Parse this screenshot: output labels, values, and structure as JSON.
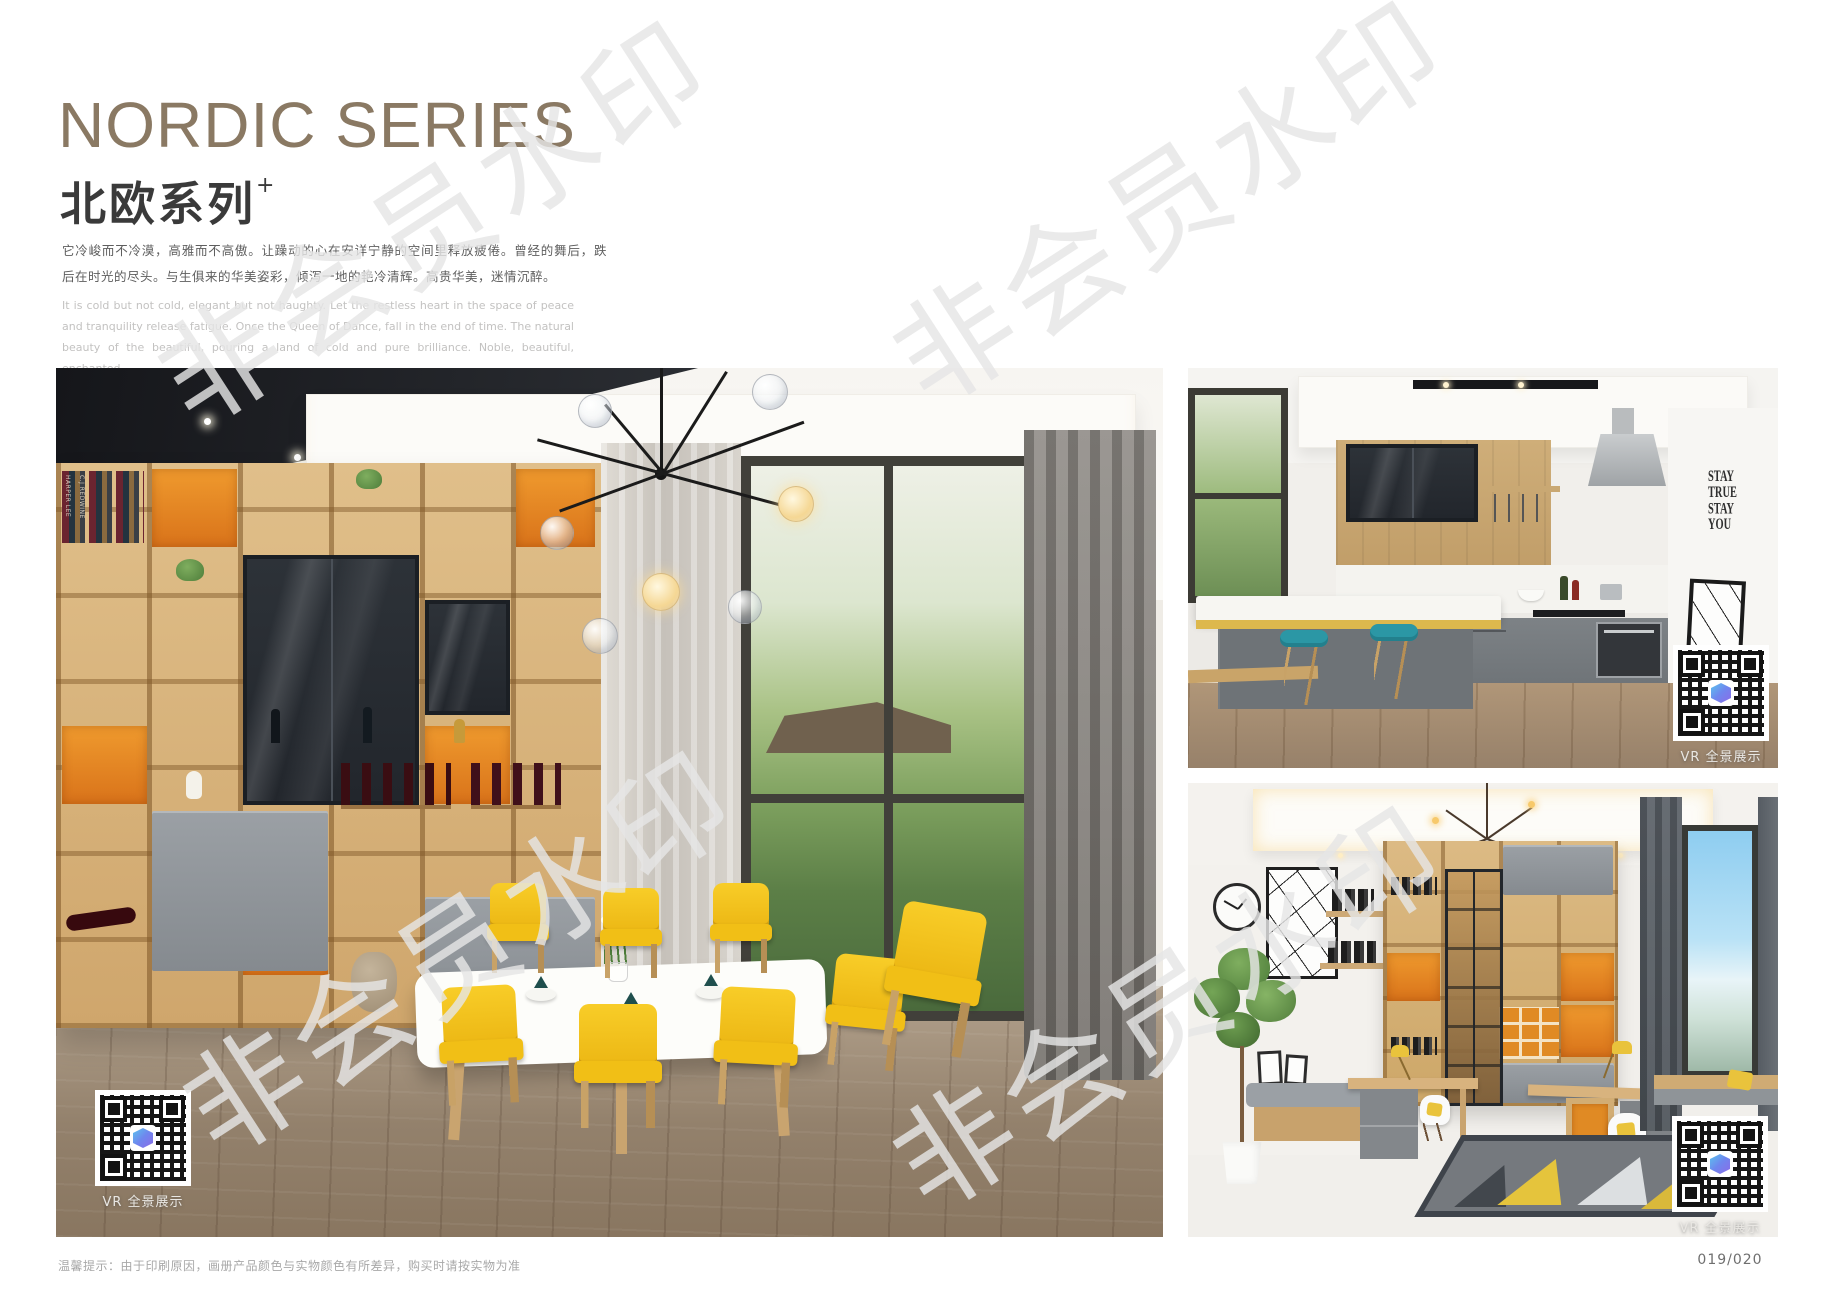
{
  "header": {
    "title_en": "NORDIC SERIES",
    "title_cn": "北欧系列",
    "title_superscript": "+",
    "description_cn": "它冷峻而不冷漠，高雅而不高傲。让躁动的心在安详宁静的空间里释放疲倦。曾经的舞后，跌后在时光的尽头。与生俱来的华美姿彩，倾泻一地的艳冷清辉。高贵华美，迷情沉醉。",
    "description_en": "It is cold but not cold, elegant but not haughty. Let the restless heart in the space of peace and tranquility release fatigue. Once the Queen of Dance, fall in the end of time. The natural beauty of the beautiful, pouring a land of cold and pure brilliance. Noble, beautiful, enchanted."
  },
  "watermark": {
    "text": "非会员水印"
  },
  "images": {
    "dining": {
      "vr_label": "VR 全景展示",
      "book_spines": [
        "HARPER LEE",
        "C.J REDWINE"
      ]
    },
    "kitchen": {
      "vr_label": "VR 全景展示",
      "wall_text_lines": [
        "STAY",
        "TRUE",
        "STAY",
        "YOU"
      ]
    },
    "study": {
      "vr_label": "VR 全景展示"
    }
  },
  "footer": {
    "disclaimer": "温馨提示：由于印刷原因，画册产品颜色与实物颜色有所差异，购买时请按实物为准",
    "page_number": "019/020"
  },
  "colors": {
    "title_bronze": "#8a7963",
    "accent_orange": "#e2811f",
    "chair_yellow": "#f3c41c",
    "stool_teal": "#2b97a5",
    "qr_logo_blue": "#5bc4ee",
    "qr_logo_purple": "#8b6ce8"
  }
}
